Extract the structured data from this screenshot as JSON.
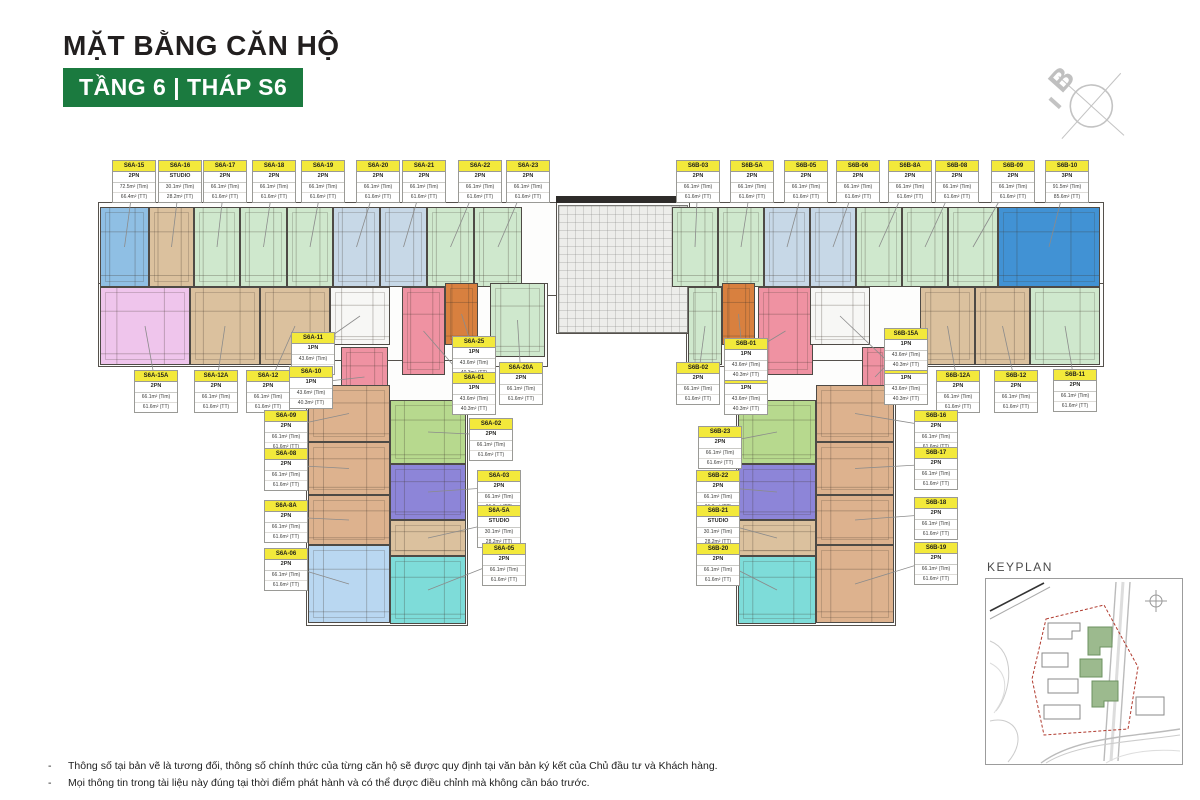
{
  "title": "MẶT BẰNG CĂN HỘ",
  "subtitle": "TẦNG 6  |  THÁP S6",
  "compass_label": "B",
  "keyplan_label": "KEYPLAN",
  "notes": [
    "Thông số tại bản vẽ là tương đối, thông số chính thức của từng căn hộ sẽ được quy định tại văn bản ký kết của Chủ đầu tư và Khách hàng.",
    "Mọi thông tin trong tài liệu này đúng tại thời điểm phát hành và có thể được điều chỉnh mà không cần báo trước."
  ],
  "theme": {
    "accent_green": "#1b7a3f",
    "label_yellow": "#f3e93b",
    "wall": "#4e4a45",
    "leader": "#8b8b8b"
  },
  "type_areas": {
    "STUDIO": {
      "tim": "30.1m² (Tim)",
      "tt": "28.2m² (TT)"
    },
    "1PN": {
      "tim": "43.6m² (Tim)",
      "tt": "40.3m² (TT)"
    },
    "2PN": {
      "tim": "66.1m² (Tim)",
      "tt": "61.6m² (TT)"
    },
    "3PN": {
      "tim": "91.5m² (Tim)",
      "tt": "85.6m² (TT)"
    }
  },
  "palette": {
    "blue_med": "#8fbfe4",
    "blue_strong": "#4192d4",
    "bluegray": "#c7d8e7",
    "green_pale": "#cfe8cd",
    "tan": "#dbc19e",
    "tan_wing": "#ddb28e",
    "pink_violet": "#efc5ec",
    "pink_red": "#ef92a2",
    "orange": "#d8803f",
    "green_mid": "#b7d98e",
    "purple": "#8d85d8",
    "cyan": "#7edcd9",
    "blue_light": "#b9d7f1",
    "white_unit": "#f7f7f5"
  },
  "plan": {
    "outline_rects": [
      [
        98,
        202,
        1006,
        94
      ],
      [
        98,
        283,
        450,
        84
      ],
      [
        686,
        283,
        418,
        84
      ],
      [
        306,
        360,
        162,
        266
      ],
      [
        736,
        360,
        160,
        266
      ],
      [
        556,
        202,
        134,
        132
      ]
    ],
    "cores": [
      {
        "kind": "dark",
        "rect": [
          556,
          196,
          134,
          7
        ]
      },
      {
        "kind": "grid",
        "rect": [
          558,
          205,
          130,
          128
        ]
      },
      {
        "kind": "hatch",
        "rect": [
          400,
          229,
          36,
          40
        ]
      },
      {
        "kind": "hatch",
        "rect": [
          764,
          229,
          36,
          40
        ]
      },
      {
        "kind": "hatch",
        "rect": [
          318,
          476,
          24,
          24
        ]
      },
      {
        "kind": "hatch",
        "rect": [
          852,
          476,
          24,
          24
        ]
      }
    ],
    "units": [
      {
        "id": "S6A-15",
        "type": "2PN",
        "color": "blue_med",
        "rect": [
          100,
          207,
          49,
          80
        ],
        "label": [
          112,
          160
        ],
        "tim": "72.5m² (Tim)",
        "tt": "66.4m² (TT)"
      },
      {
        "id": "S6A-16",
        "type": "STUDIO",
        "color": "tan",
        "rect": [
          149,
          207,
          45,
          80
        ],
        "label": [
          158,
          160
        ]
      },
      {
        "id": "S6A-17",
        "type": "2PN",
        "color": "green_pale",
        "rect": [
          194,
          207,
          46,
          80
        ],
        "label": [
          203,
          160
        ]
      },
      {
        "id": "S6A-18",
        "type": "2PN",
        "color": "green_pale",
        "rect": [
          240,
          207,
          47,
          80
        ],
        "label": [
          252,
          160
        ]
      },
      {
        "id": "S6A-19",
        "type": "2PN",
        "color": "green_pale",
        "rect": [
          287,
          207,
          46,
          80
        ],
        "label": [
          301,
          160
        ]
      },
      {
        "id": "S6A-20",
        "type": "2PN",
        "color": "bluegray",
        "rect": [
          333,
          207,
          47,
          80
        ],
        "label": [
          356,
          160
        ]
      },
      {
        "id": "S6A-21",
        "type": "2PN",
        "color": "bluegray",
        "rect": [
          380,
          207,
          47,
          80
        ],
        "label": [
          402,
          160
        ]
      },
      {
        "id": "S6A-22",
        "type": "2PN",
        "color": "green_pale",
        "rect": [
          427,
          207,
          47,
          80
        ],
        "label": [
          458,
          160
        ]
      },
      {
        "id": "S6A-23",
        "type": "2PN",
        "color": "green_pale",
        "rect": [
          474,
          207,
          48,
          80
        ],
        "label": [
          506,
          160
        ]
      },
      {
        "id": "S6B-03",
        "type": "2PN",
        "color": "green_pale",
        "rect": [
          672,
          207,
          46,
          80
        ],
        "label": [
          676,
          160
        ]
      },
      {
        "id": "S6B-5A",
        "type": "2PN",
        "color": "green_pale",
        "rect": [
          718,
          207,
          46,
          80
        ],
        "label": [
          730,
          160
        ]
      },
      {
        "id": "S6B-05",
        "type": "2PN",
        "color": "bluegray",
        "rect": [
          764,
          207,
          46,
          80
        ],
        "label": [
          784,
          160
        ]
      },
      {
        "id": "S6B-06",
        "type": "2PN",
        "color": "bluegray",
        "rect": [
          810,
          207,
          46,
          80
        ],
        "label": [
          836,
          160
        ]
      },
      {
        "id": "S6B-8A",
        "type": "2PN",
        "color": "green_pale",
        "rect": [
          856,
          207,
          46,
          80
        ],
        "label": [
          888,
          160
        ]
      },
      {
        "id": "S6B-08",
        "type": "2PN",
        "color": "green_pale",
        "rect": [
          902,
          207,
          46,
          80
        ],
        "label": [
          935,
          160
        ]
      },
      {
        "id": "S6B-09",
        "type": "2PN",
        "color": "green_pale",
        "rect": [
          948,
          207,
          50,
          80
        ],
        "label": [
          991,
          160
        ]
      },
      {
        "id": "S6B-10",
        "type": "3PN",
        "color": "blue_strong",
        "rect": [
          998,
          207,
          102,
          80
        ],
        "label": [
          1045,
          160
        ]
      },
      {
        "id": "S6A-15A",
        "type": "2PN",
        "color": "pink_violet",
        "rect": [
          100,
          287,
          90,
          78
        ],
        "label": [
          134,
          370
        ]
      },
      {
        "id": "S6A-12A",
        "type": "2PN",
        "color": "tan",
        "rect": [
          190,
          287,
          70,
          78
        ],
        "label": [
          194,
          370
        ]
      },
      {
        "id": "S6A-12",
        "type": "2PN",
        "color": "tan",
        "rect": [
          260,
          287,
          70,
          78
        ],
        "label": [
          246,
          370
        ]
      },
      {
        "id": "S6A-11",
        "type": "1PN",
        "color": "white_unit",
        "rect": [
          330,
          287,
          60,
          58
        ],
        "label": [
          291,
          332
        ]
      },
      {
        "id": "S6A-10",
        "type": "1PN",
        "color": "pink_red",
        "rect": [
          341,
          347,
          47,
          60
        ],
        "label": [
          289,
          366
        ]
      },
      {
        "id": "S6A-25",
        "type": "1PN",
        "color": "orange",
        "rect": [
          445,
          283,
          33,
          62
        ],
        "label": [
          452,
          336
        ]
      },
      {
        "id": "S6A-01",
        "type": "1PN",
        "color": "pink_red",
        "rect": [
          402,
          287,
          43,
          88
        ],
        "label": [
          452,
          372
        ]
      },
      {
        "id": "S6A-20A",
        "type": "2PN",
        "color": "green_pale",
        "rect": [
          490,
          283,
          55,
          74
        ],
        "label": [
          499,
          362
        ]
      },
      {
        "id": "S6B-02",
        "type": "2PN",
        "color": "green_pale",
        "rect": [
          688,
          287,
          34,
          78
        ],
        "label": [
          676,
          362
        ]
      },
      {
        "id": "S6B-25A",
        "type": "1PN",
        "color": "orange",
        "rect": [
          722,
          283,
          33,
          62
        ],
        "label": [
          724,
          372
        ]
      },
      {
        "id": "S6B-01",
        "type": "1PN",
        "color": "pink_red",
        "rect": [
          758,
          287,
          55,
          88
        ],
        "label": [
          724,
          338
        ]
      },
      {
        "id": "S6B-15",
        "type": "1PN",
        "color": "white_unit",
        "rect": [
          810,
          287,
          60,
          58
        ],
        "label": [
          884,
          362
        ]
      },
      {
        "id": "S6B-15A",
        "type": "1PN",
        "color": "pink_red",
        "rect": [
          862,
          347,
          26,
          60
        ],
        "label": [
          884,
          328
        ]
      },
      {
        "id": "S6B-12A",
        "type": "2PN",
        "color": "tan",
        "rect": [
          920,
          287,
          55,
          78
        ],
        "label": [
          936,
          370
        ]
      },
      {
        "id": "S6B-12",
        "type": "2PN",
        "color": "tan",
        "rect": [
          975,
          287,
          55,
          78
        ],
        "label": [
          994,
          370
        ]
      },
      {
        "id": "S6B-11",
        "type": "2PN",
        "color": "green_pale",
        "rect": [
          1030,
          287,
          70,
          78
        ],
        "label": [
          1053,
          369
        ]
      },
      {
        "id": "S6A-09",
        "type": "2PN",
        "color": "tan_wing",
        "rect": [
          308,
          385,
          82,
          57
        ],
        "label": [
          264,
          410
        ]
      },
      {
        "id": "S6A-08",
        "type": "2PN",
        "color": "tan_wing",
        "rect": [
          308,
          442,
          82,
          53
        ],
        "label": [
          264,
          448
        ]
      },
      {
        "id": "S6A-8A",
        "type": "2PN",
        "color": "tan_wing",
        "rect": [
          308,
          495,
          82,
          50
        ],
        "label": [
          264,
          500
        ]
      },
      {
        "id": "S6A-06",
        "type": "2PN",
        "color": "blue_light",
        "rect": [
          308,
          545,
          82,
          78
        ],
        "label": [
          264,
          548
        ]
      },
      {
        "id": "S6A-02",
        "type": "2PN",
        "color": "green_mid",
        "rect": [
          390,
          400,
          76,
          64
        ],
        "label": [
          469,
          418
        ]
      },
      {
        "id": "S6A-03",
        "type": "2PN",
        "color": "purple",
        "rect": [
          390,
          464,
          76,
          56
        ],
        "label": [
          477,
          470
        ]
      },
      {
        "id": "S6A-5A",
        "type": "STUDIO",
        "color": "tan",
        "rect": [
          390,
          520,
          76,
          36
        ],
        "label": [
          477,
          505
        ]
      },
      {
        "id": "S6A-05",
        "type": "2PN",
        "color": "cyan",
        "rect": [
          390,
          556,
          76,
          68
        ],
        "label": [
          482,
          543
        ]
      },
      {
        "id": "S6B-23",
        "type": "2PN",
        "color": "green_mid",
        "rect": [
          738,
          400,
          78,
          64
        ],
        "label": [
          698,
          426
        ]
      },
      {
        "id": "S6B-22",
        "type": "2PN",
        "color": "purple",
        "rect": [
          738,
          464,
          78,
          56
        ],
        "label": [
          696,
          470
        ]
      },
      {
        "id": "S6B-21",
        "type": "STUDIO",
        "color": "tan",
        "rect": [
          738,
          520,
          78,
          36
        ],
        "label": [
          696,
          505
        ]
      },
      {
        "id": "S6B-20",
        "type": "2PN",
        "color": "cyan",
        "rect": [
          738,
          556,
          78,
          68
        ],
        "label": [
          696,
          543
        ]
      },
      {
        "id": "S6B-16",
        "type": "2PN",
        "color": "tan_wing",
        "rect": [
          816,
          385,
          78,
          57
        ],
        "label": [
          914,
          410
        ]
      },
      {
        "id": "S6B-17",
        "type": "2PN",
        "color": "tan_wing",
        "rect": [
          816,
          442,
          78,
          53
        ],
        "label": [
          914,
          447
        ]
      },
      {
        "id": "S6B-18",
        "type": "2PN",
        "color": "tan_wing",
        "rect": [
          816,
          495,
          78,
          50
        ],
        "label": [
          914,
          497
        ]
      },
      {
        "id": "S6B-19",
        "type": "2PN",
        "color": "tan_wing",
        "rect": [
          816,
          545,
          78,
          78
        ],
        "label": [
          914,
          542
        ]
      }
    ]
  }
}
